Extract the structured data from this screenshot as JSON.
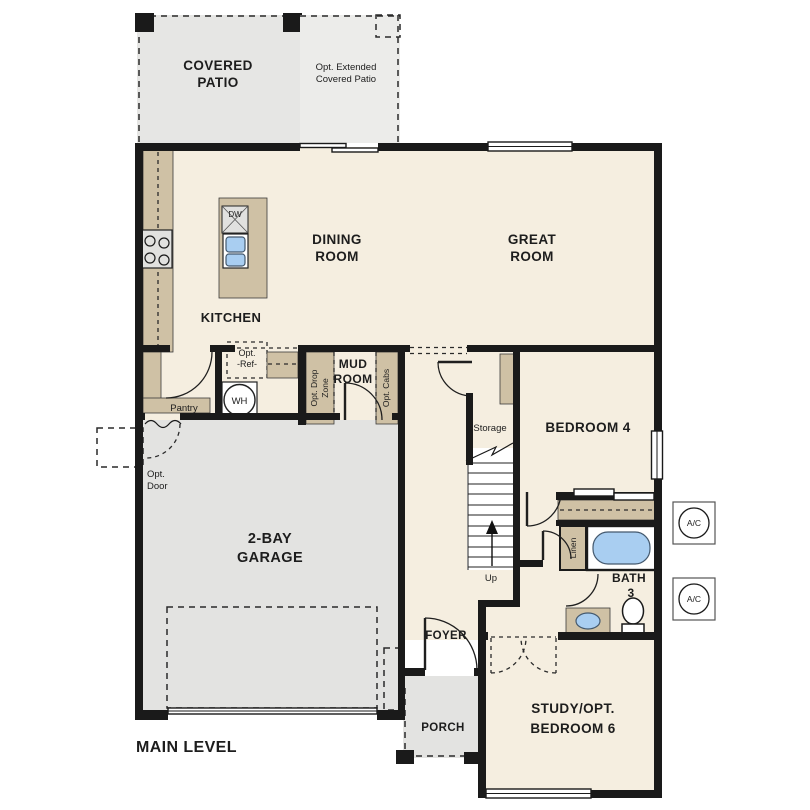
{
  "plan": {
    "level_label": "MAIN LEVEL",
    "labels": {
      "covered_patio": [
        "COVERED",
        "PATIO"
      ],
      "opt_extended_patio": [
        "Opt. Extended",
        "Covered Patio"
      ],
      "dining_room": [
        "DINING",
        "ROOM"
      ],
      "great_room": [
        "GREAT",
        "ROOM"
      ],
      "kitchen": "KITCHEN",
      "pantry": "Pantry",
      "opt_ref": [
        "Opt.",
        "-Ref-"
      ],
      "water_heater": "WH",
      "dishwasher": "DW",
      "mud_room": [
        "MUD",
        "ROOM"
      ],
      "opt_drop_zone": [
        "Opt. Drop",
        "Zone"
      ],
      "opt_cabs": "Opt. Cabs",
      "opt_door": [
        "Opt.",
        "Door"
      ],
      "garage": [
        "2-BAY",
        "GARAGE"
      ],
      "storage": "Storage",
      "stairs_up": "Up",
      "bedroom_4": "BEDROOM 4",
      "linen": "Linen",
      "bath_3": [
        "BATH",
        "3"
      ],
      "foyer": "FOYER",
      "porch": "PORCH",
      "study": [
        "STUDY/OPT.",
        "BEDROOM 6"
      ],
      "ac_unit": "A/C"
    },
    "colors": {
      "wall": "#1a1a1a",
      "floor_cream": "#f5eee0",
      "floor_grey": "#e3e3e1",
      "counter_tan": "#cfc1a5",
      "fixture_blue": "#a9cef1",
      "appliance_grey": "#e1e1df"
    }
  }
}
